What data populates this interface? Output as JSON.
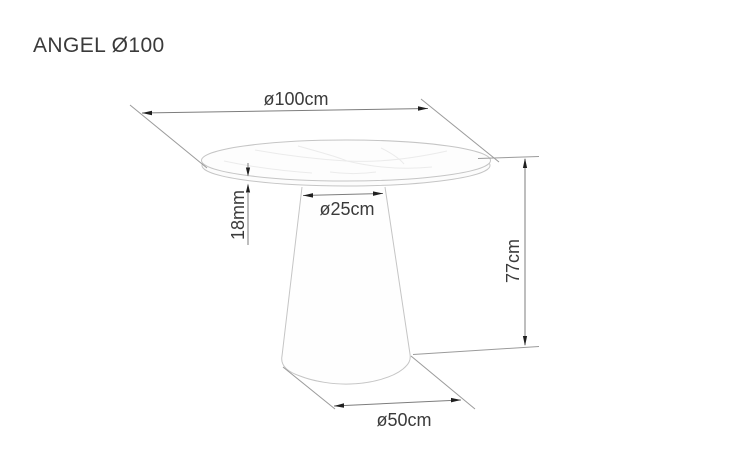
{
  "header": {
    "title": "ANGEL Ø100"
  },
  "drawing": {
    "subject": "round-pedestal-table-dimension-drawing",
    "labels": {
      "top_diameter": "ø100cm",
      "top_thickness": "18mm",
      "column_diameter": "ø25cm",
      "height": "77cm",
      "base_diameter": "ø50cm"
    },
    "colors": {
      "background": "#ffffff",
      "text": "#3a3a3a",
      "dimension_line": "#7d7d7d",
      "extension_line": "#9b9b9b",
      "arrowhead": "#1f1f1f",
      "table_outline": "#c5c5c5",
      "table_fill": "#fdfdfd"
    }
  }
}
